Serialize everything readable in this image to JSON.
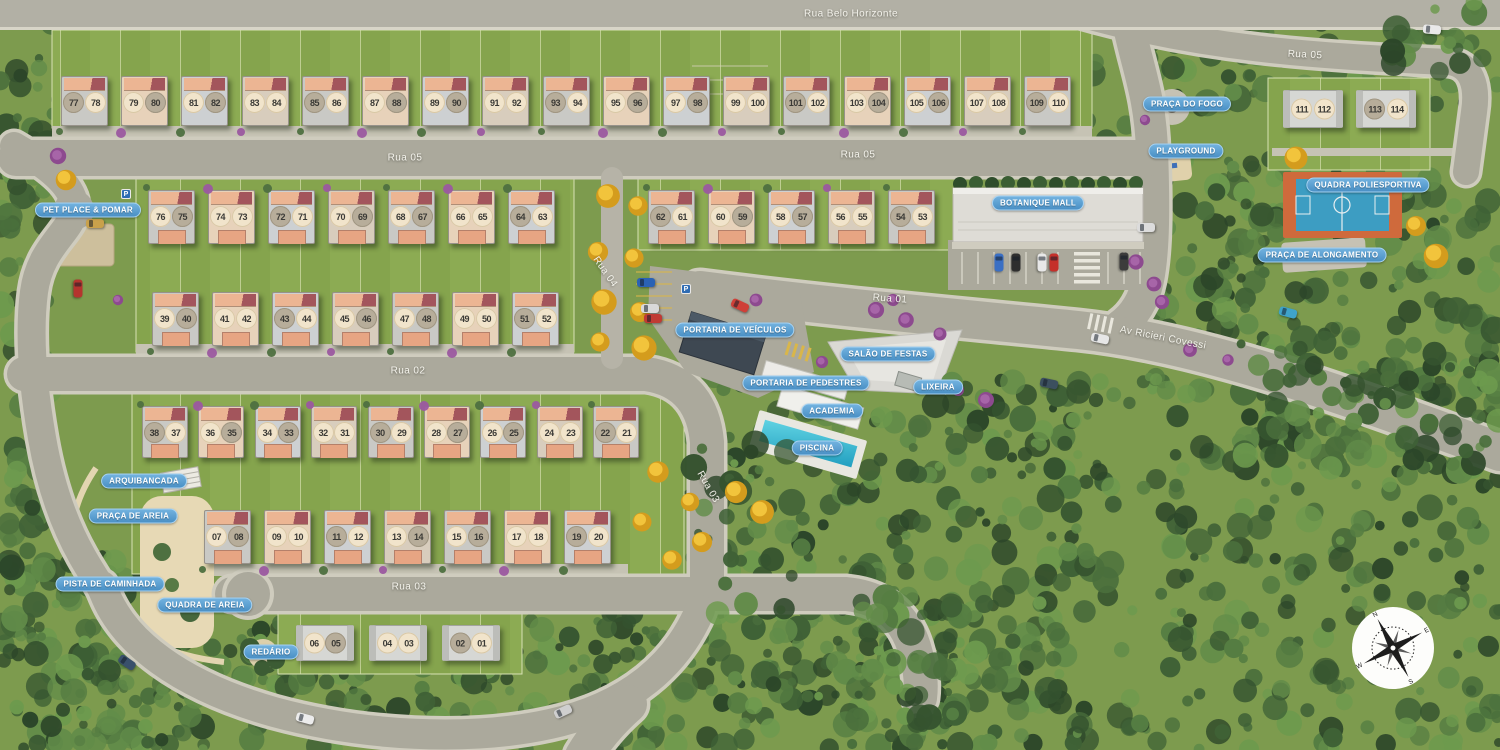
{
  "title": "Residential condominium masterplan",
  "streets": [
    {
      "text": "Rua Belo Horizonte",
      "x": 851,
      "y": 14,
      "rot": 0
    },
    {
      "text": "Rua 05",
      "x": 1305,
      "y": 55,
      "rot": 3
    },
    {
      "text": "Rua 05",
      "x": 405,
      "y": 158,
      "rot": 0
    },
    {
      "text": "Rua 05",
      "x": 858,
      "y": 155,
      "rot": 0
    },
    {
      "text": "Rua 04",
      "x": 605,
      "y": 272,
      "rot": 55
    },
    {
      "text": "Rua 01",
      "x": 890,
      "y": 299,
      "rot": 4
    },
    {
      "text": "Rua 02",
      "x": 408,
      "y": 371,
      "rot": 0
    },
    {
      "text": "Av Ricieri Covessi",
      "x": 1163,
      "y": 338,
      "rot": 11
    },
    {
      "text": "Rua 03",
      "x": 708,
      "y": 487,
      "rot": 60
    },
    {
      "text": "Rua 03",
      "x": 409,
      "y": 587,
      "rot": 0
    }
  ],
  "amenity_labels": [
    {
      "text": "PRAÇA DO FOGO",
      "x": 1187,
      "y": 104
    },
    {
      "text": "PLAYGROUND",
      "x": 1186,
      "y": 151
    },
    {
      "text": "QUADRA POLIESPORTIVA",
      "x": 1368,
      "y": 185
    },
    {
      "text": "PRAÇA DE ALONGAMENTO",
      "x": 1322,
      "y": 255
    },
    {
      "text": "BOTANIQUE MALL",
      "x": 1038,
      "y": 203
    },
    {
      "text": "PET PLACE & POMAR",
      "x": 88,
      "y": 210
    },
    {
      "text": "PORTARIA DE VEÍCULOS",
      "x": 735,
      "y": 330
    },
    {
      "text": "SALÃO DE FESTAS",
      "x": 888,
      "y": 354
    },
    {
      "text": "PORTARIA DE PEDESTRES",
      "x": 806,
      "y": 383
    },
    {
      "text": "LIXEIRA",
      "x": 938,
      "y": 387
    },
    {
      "text": "ACADEMIA",
      "x": 832,
      "y": 411
    },
    {
      "text": "PISCINA",
      "x": 817,
      "y": 448
    },
    {
      "text": "ARQUIBANCADA",
      "x": 144,
      "y": 481
    },
    {
      "text": "PRAÇA DE AREIA",
      "x": 133,
      "y": 516
    },
    {
      "text": "PISTA DE CAMINHADA",
      "x": 110,
      "y": 584
    },
    {
      "text": "QUADRA DE AREIA",
      "x": 205,
      "y": 605
    },
    {
      "text": "REDÁRIO",
      "x": 271,
      "y": 652
    }
  ],
  "house_rows": [
    {
      "id": "row-77-110",
      "style": "std",
      "start_x": 61,
      "y": 76,
      "pitch": 60.2,
      "w": 47,
      "h": 50,
      "garage": false,
      "bush_y": 128,
      "units": [
        [
          "77",
          "78"
        ],
        [
          "79",
          "80"
        ],
        [
          "81",
          "82"
        ],
        [
          "83",
          "84"
        ],
        [
          "85",
          "86"
        ],
        [
          "87",
          "88"
        ],
        [
          "89",
          "90"
        ],
        [
          "91",
          "92"
        ],
        [
          "93",
          "94"
        ],
        [
          "95",
          "96"
        ],
        [
          "97",
          "98"
        ],
        [
          "99",
          "100"
        ],
        [
          "101",
          "102"
        ],
        [
          "103",
          "104"
        ],
        [
          "105",
          "106"
        ],
        [
          "107",
          "108"
        ],
        [
          "109",
          "110"
        ]
      ]
    },
    {
      "id": "row-76-63",
      "style": "std",
      "start_x": 148,
      "y": 190,
      "pitch": 60,
      "w": 47,
      "h": 54,
      "garage": true,
      "bush_y": 184,
      "units": [
        [
          "76",
          "75"
        ],
        [
          "74",
          "73"
        ],
        [
          "72",
          "71"
        ],
        [
          "70",
          "69"
        ],
        [
          "68",
          "67"
        ],
        [
          "66",
          "65"
        ],
        [
          "64",
          "63"
        ]
      ]
    },
    {
      "id": "row-62-53",
      "style": "std",
      "start_x": 648,
      "y": 190,
      "pitch": 60,
      "w": 47,
      "h": 54,
      "garage": true,
      "bush_y": 184,
      "units": [
        [
          "62",
          "61"
        ],
        [
          "60",
          "59"
        ],
        [
          "58",
          "57"
        ],
        [
          "56",
          "55"
        ],
        [
          "54",
          "53"
        ]
      ]
    },
    {
      "id": "row-39-52",
      "style": "std",
      "start_x": 152,
      "y": 292,
      "pitch": 60,
      "w": 47,
      "h": 54,
      "garage": true,
      "bush_y": 348,
      "units": [
        [
          "39",
          "40"
        ],
        [
          "41",
          "42"
        ],
        [
          "43",
          "44"
        ],
        [
          "45",
          "46"
        ],
        [
          "47",
          "48"
        ],
        [
          "49",
          "50"
        ],
        [
          "51",
          "52"
        ]
      ]
    },
    {
      "id": "row-38-21",
      "style": "std",
      "start_x": 142,
      "y": 406,
      "pitch": 56.4,
      "w": 46,
      "h": 52,
      "garage": true,
      "bush_y": 401,
      "units": [
        [
          "38",
          "37"
        ],
        [
          "36",
          "35"
        ],
        [
          "34",
          "33"
        ],
        [
          "32",
          "31"
        ],
        [
          "30",
          "29"
        ],
        [
          "28",
          "27"
        ],
        [
          "26",
          "25"
        ],
        [
          "24",
          "23"
        ],
        [
          "22",
          "21"
        ]
      ]
    },
    {
      "id": "row-07-20",
      "style": "std",
      "start_x": 204,
      "y": 510,
      "pitch": 60,
      "w": 47,
      "h": 54,
      "garage": true,
      "bush_y": 566,
      "units": [
        [
          "07",
          "08"
        ],
        [
          "09",
          "10"
        ],
        [
          "11",
          "12"
        ],
        [
          "13",
          "14"
        ],
        [
          "15",
          "16"
        ],
        [
          "17",
          "18"
        ],
        [
          "19",
          "20"
        ]
      ]
    },
    {
      "id": "row-06-01",
      "style": "flat",
      "start_x": 296,
      "y": 625,
      "pitch": 73,
      "w": 58,
      "h": 36,
      "garage": false,
      "bush_y": 0,
      "units": [
        [
          "06",
          "05"
        ],
        [
          "04",
          "03"
        ],
        [
          "02",
          "01"
        ]
      ]
    },
    {
      "id": "row-111-114",
      "style": "flat",
      "start_x": 1283,
      "y": 90,
      "pitch": 73,
      "w": 60,
      "h": 38,
      "garage": false,
      "bush_y": 0,
      "units": [
        [
          "111",
          "112"
        ],
        [
          "113",
          "114"
        ]
      ]
    }
  ],
  "cars": [
    {
      "x": 78,
      "y": 289,
      "c": "#b5342e",
      "r": 90
    },
    {
      "x": 95,
      "y": 224,
      "c": "#c9a14b",
      "r": 0
    },
    {
      "x": 646,
      "y": 283,
      "c": "#2a62b5",
      "r": 0
    },
    {
      "x": 650,
      "y": 309,
      "c": "#d9d9d9",
      "r": 0
    },
    {
      "x": 653,
      "y": 319,
      "c": "#c03a34",
      "r": 0
    },
    {
      "x": 740,
      "y": 306,
      "c": "#cf4038",
      "r": 25
    },
    {
      "x": 999,
      "y": 263,
      "c": "#3a6fc4",
      "r": 90
    },
    {
      "x": 1016,
      "y": 263,
      "c": "#2e2e2e",
      "r": 90
    },
    {
      "x": 1042,
      "y": 263,
      "c": "#e8e8e8",
      "r": 90
    },
    {
      "x": 1054,
      "y": 263,
      "c": "#c5302a",
      "r": 90
    },
    {
      "x": 1124,
      "y": 262,
      "c": "#3c3c3c",
      "r": 90
    },
    {
      "x": 1146,
      "y": 228,
      "c": "#dcdcdc",
      "r": 0
    },
    {
      "x": 1100,
      "y": 339,
      "c": "#e6e6e6",
      "r": 12
    },
    {
      "x": 1049,
      "y": 384,
      "c": "#3c4f5e",
      "r": 12
    },
    {
      "x": 1288,
      "y": 313,
      "c": "#3fa3c9",
      "r": 15
    },
    {
      "x": 305,
      "y": 719,
      "c": "#ececec",
      "r": 15
    },
    {
      "x": 563,
      "y": 712,
      "c": "#cfcfcf",
      "r": -25
    },
    {
      "x": 127,
      "y": 663,
      "c": "#39506b",
      "r": 35
    },
    {
      "x": 1432,
      "y": 30,
      "c": "#e9e9e9",
      "r": 5
    }
  ],
  "parking_signs": [
    {
      "x": 126,
      "y": 194,
      "label": "P"
    },
    {
      "x": 686,
      "y": 289,
      "label": "P"
    }
  ],
  "compass": {
    "n": "N",
    "e": "E",
    "s": "S",
    "w": "W"
  },
  "colors": {
    "pill_bg": "#4a90c5",
    "road": "#aba99c",
    "sidewalk": "#cfccbe",
    "lawn": "#8cab53",
    "forest_dark": "#35532f",
    "pool": "#3fc0d4",
    "court_orange": "#cf6a3c",
    "court_blue": "#3d9dc2",
    "roof_peach": "#ecb593",
    "roof_red": "#a3555c",
    "circle_cream": "#f1e4cb",
    "circle_taupe": "#b7ad9a",
    "sand": "#e7d9b5",
    "ipe_yellow": "#e8b322",
    "quaresmeira_purple": "#9b59a0"
  }
}
